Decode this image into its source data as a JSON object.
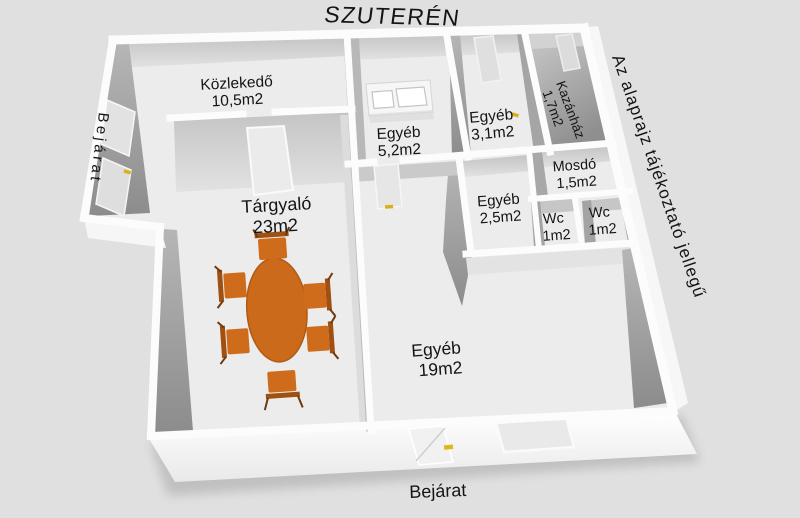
{
  "title": "SZUTERÉN",
  "disclaimer": "Az alaprajz tájékoztató jellegű",
  "entrance_left": "Bejárat",
  "entrance_bottom": "Bejárat",
  "rooms": [
    {
      "id": "kozlekedo",
      "name": "Közlekedő",
      "area": "10,5m2"
    },
    {
      "id": "egyeb52",
      "name": "Egyéb",
      "area": "5,2m2"
    },
    {
      "id": "egyeb31",
      "name": "Egyéb",
      "area": "3,1m2"
    },
    {
      "id": "kazanhaz",
      "name": "Kazánház",
      "area": "1,7m2"
    },
    {
      "id": "mosdo",
      "name": "Mosdó",
      "area": "1,5m2"
    },
    {
      "id": "egyeb25",
      "name": "Egyéb",
      "area": "2,5m2"
    },
    {
      "id": "wc-left",
      "name": "Wc",
      "area": "1m2"
    },
    {
      "id": "wc-right",
      "name": "Wc",
      "area": "1m2"
    },
    {
      "id": "targyalo",
      "name": "Tárgyaló",
      "area": "23m2"
    },
    {
      "id": "egyeb19",
      "name": "Egyéb",
      "area": "19m2"
    }
  ],
  "furniture": {
    "conference_table": "oval-table",
    "chair_count": 6
  },
  "colors": {
    "background": "#e0e0e0",
    "floor": "#ececec",
    "wall": "#fcfcfc",
    "wall_face_dark": "#8f8f8f",
    "wall_face_light": "#c9c9c9",
    "furniture_orange": "#cb6a1b",
    "door_handle_yellow": "#d8b11c",
    "text": "#141414"
  }
}
